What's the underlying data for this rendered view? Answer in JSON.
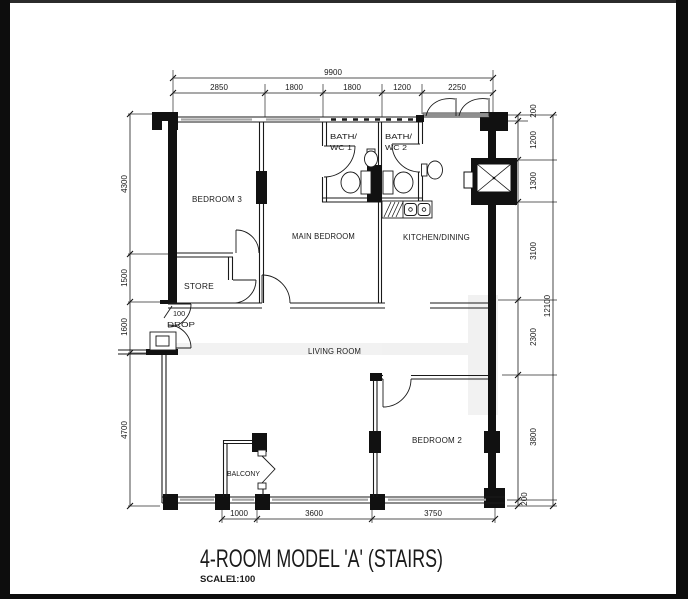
{
  "title": {
    "name": "4-ROOM MODEL 'A' (STAIRS)",
    "scale_label": "SCALE",
    "scale_value": "1:100"
  },
  "rooms": {
    "bedroom3": "BEDROOM 3",
    "main_bedroom": "MAIN BEDROOM",
    "kitchen_dining": "KITCHEN/DINING",
    "living_room": "LIVING ROOM",
    "bedroom2": "BEDROOM 2",
    "store": "STORE",
    "balcony": "BALCONY",
    "bath1_line1": "BATH/",
    "bath1_line2": "WC 1",
    "bath2_line1": "BATH/",
    "bath2_line2": "WC 2",
    "drop_line1": "100",
    "drop_line2": "DROP"
  },
  "dims": {
    "top_total": "9900",
    "top_segments": [
      "2850",
      "1800",
      "1800",
      "1200",
      "2250"
    ],
    "left_segments": [
      "4300",
      "1500",
      "1600",
      "4700"
    ],
    "right_total": "12100",
    "right_segments": [
      "200",
      "1200",
      "1300",
      "3100",
      "2300",
      "3800",
      "200"
    ],
    "bottom_segments": [
      "1000",
      "3600",
      "3750"
    ]
  },
  "colors": {
    "ink": "#1a1a1a",
    "window_gray": "#a6a6a6",
    "door_gray": "#8f8f8f",
    "frame_black": "#0d0d0d"
  }
}
